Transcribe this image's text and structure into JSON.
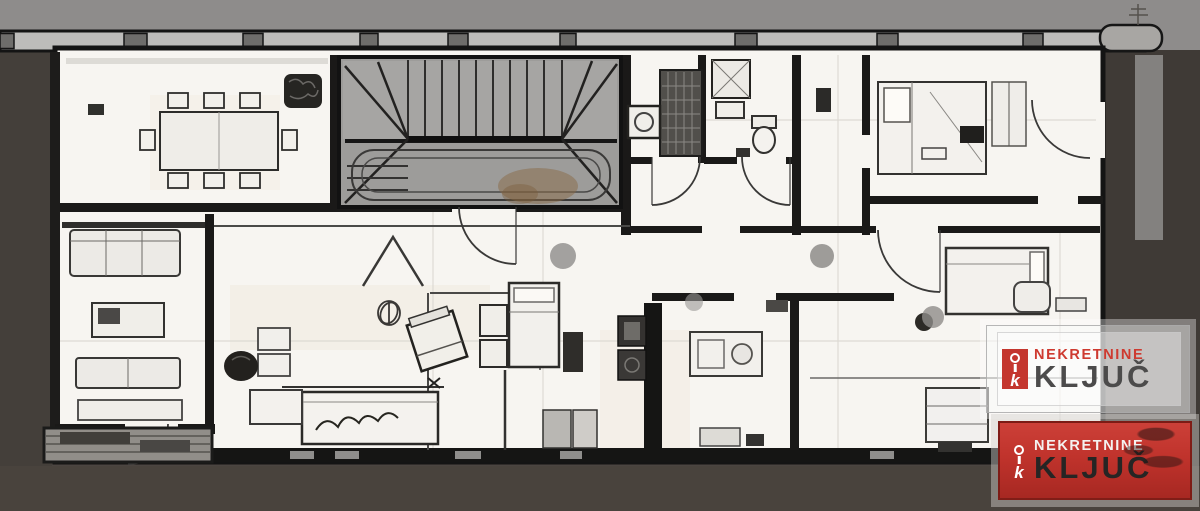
{
  "watermark_upper": {
    "brand_line1": "NEKRETNINE",
    "brand_line2": "KLJUČ",
    "icon_letter": "k"
  },
  "watermark_lower": {
    "brand_line1": "NEKRETNINE",
    "brand_line2": "KLJUČ",
    "icon_letter": "k"
  },
  "palette": {
    "background_top": "#8e8c8b",
    "background_bottom": "#4a4440",
    "paper": "#f7f5f1",
    "wall": "#161615",
    "stair_gray": "#9d9c9a",
    "accent_red": "#c4362e",
    "brand_text_dark": "#4c4b4b",
    "smudge_brown": "#8a6a45"
  }
}
